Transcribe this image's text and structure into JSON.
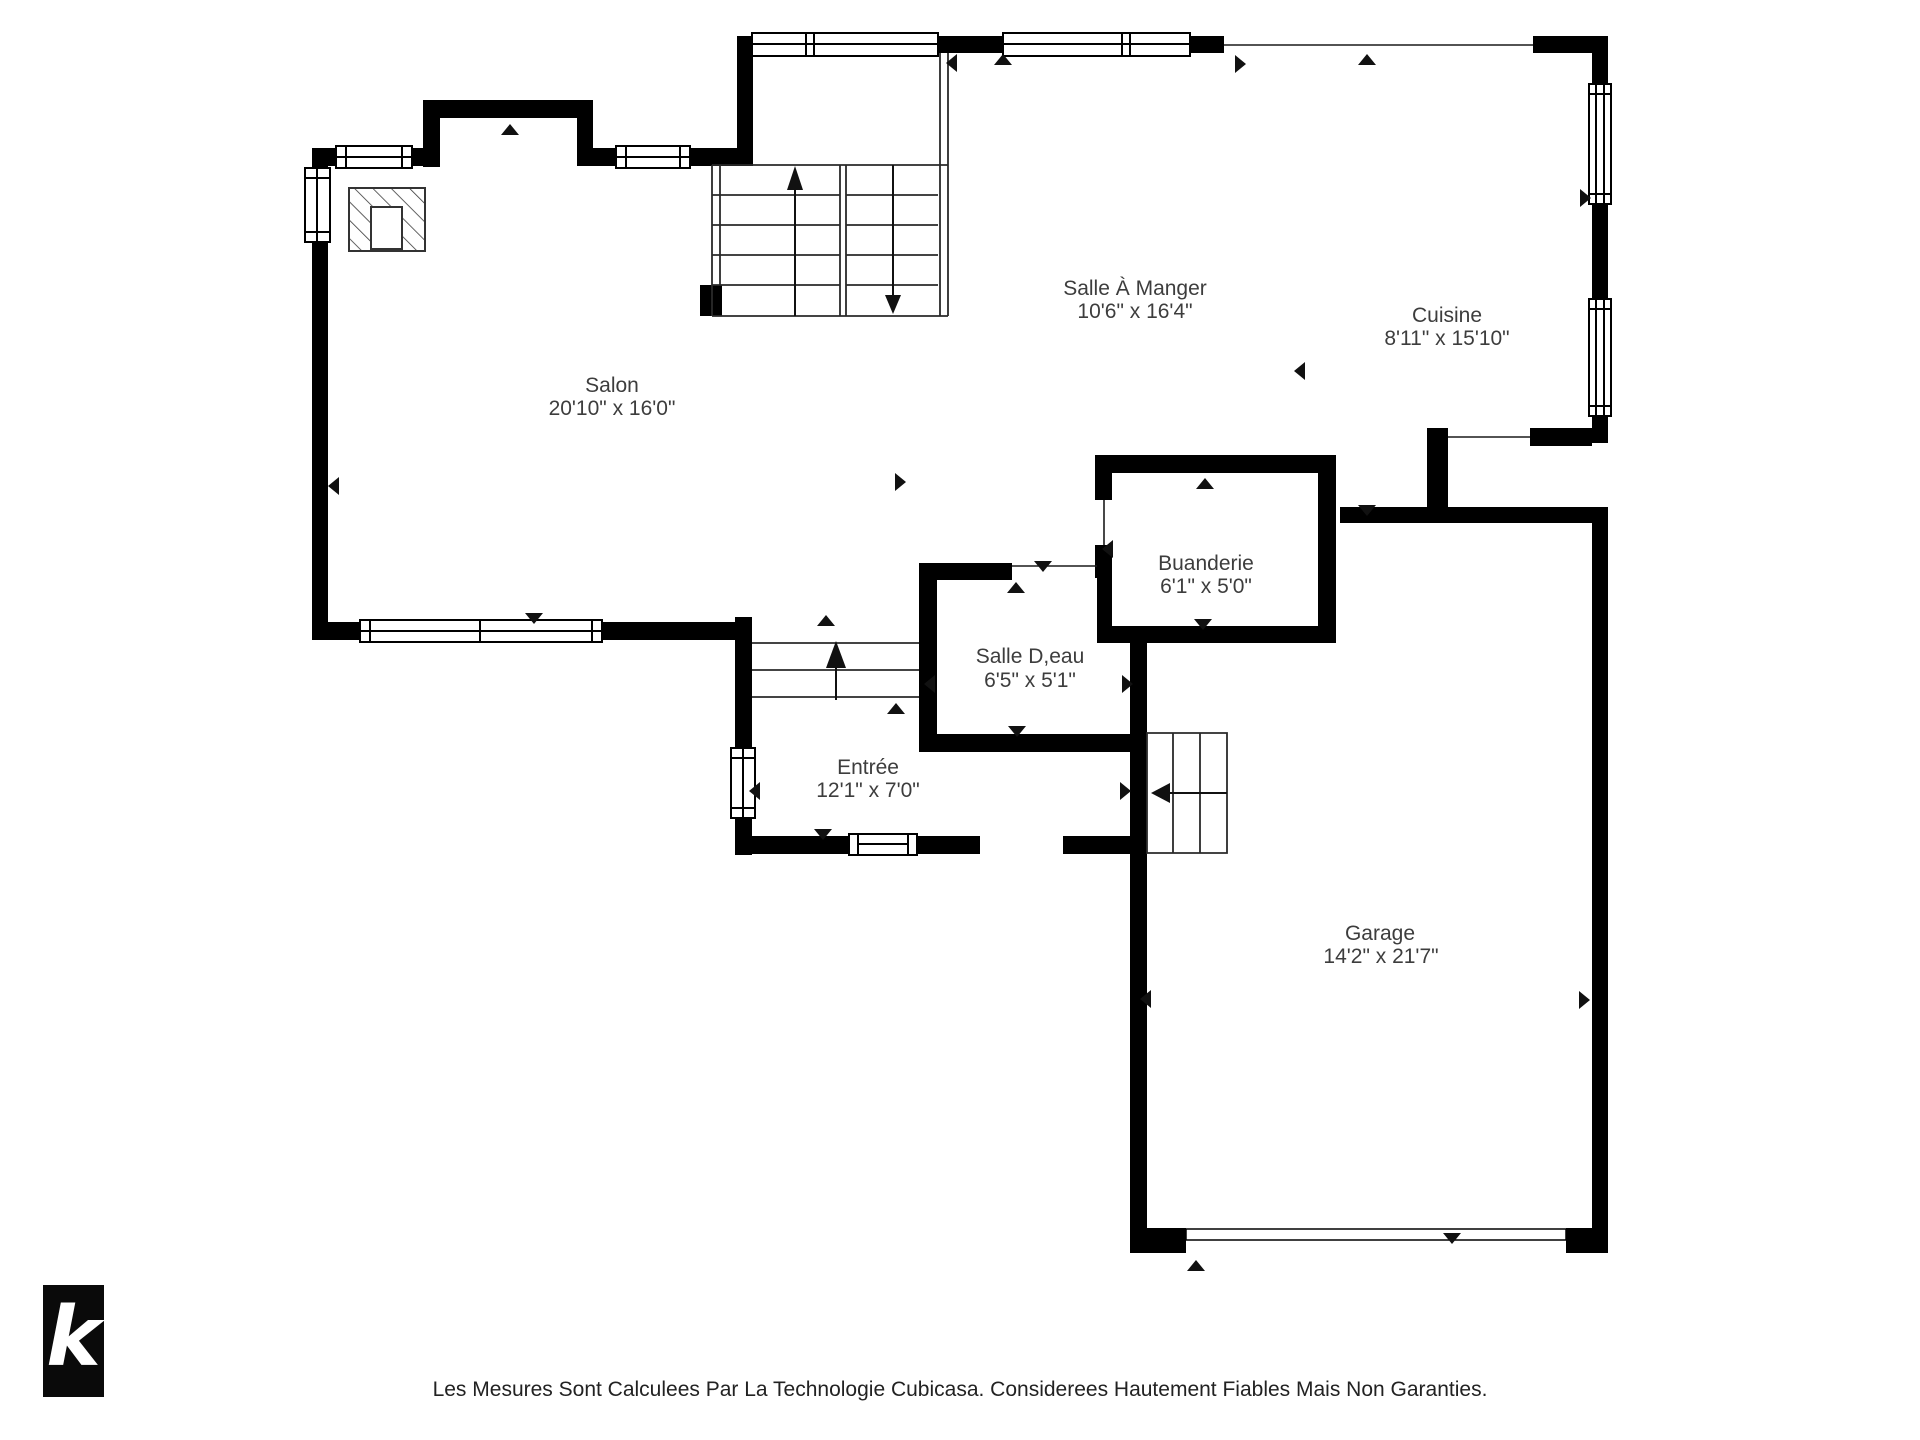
{
  "title": "Floor plan - Rez-de-chaussee",
  "colors": {
    "wall": "#000000",
    "label": "#3d3d3d",
    "background": "#ffffff",
    "logo_bg": "#0a0a0a",
    "logo_fg": "#ffffff"
  },
  "rooms": [
    {
      "id": "salon",
      "name": "Salon",
      "dims": "20'10\" x 16'0\""
    },
    {
      "id": "salle-a-manger",
      "name": "Salle À Manger",
      "dims": "10'6\" x 16'4\""
    },
    {
      "id": "cuisine",
      "name": "Cuisine",
      "dims": "8'11\" x 15'10\""
    },
    {
      "id": "buanderie",
      "name": "Buanderie",
      "dims": "6'1\" x 5'0\""
    },
    {
      "id": "salle-deau",
      "name": "Salle D,eau",
      "dims": "6'5\" x 5'1\""
    },
    {
      "id": "entree",
      "name": "Entrée",
      "dims": "12'1\" x 7'0\""
    },
    {
      "id": "garage",
      "name": "Garage",
      "dims": "14'2\" x 21'7\""
    }
  ],
  "logo": {
    "letter": "k"
  },
  "footer": {
    "disclaimer": "Les Mesures Sont Calculees Par La Technologie Cubicasa. Considerees Hautement Fiables Mais Non Garanties."
  }
}
